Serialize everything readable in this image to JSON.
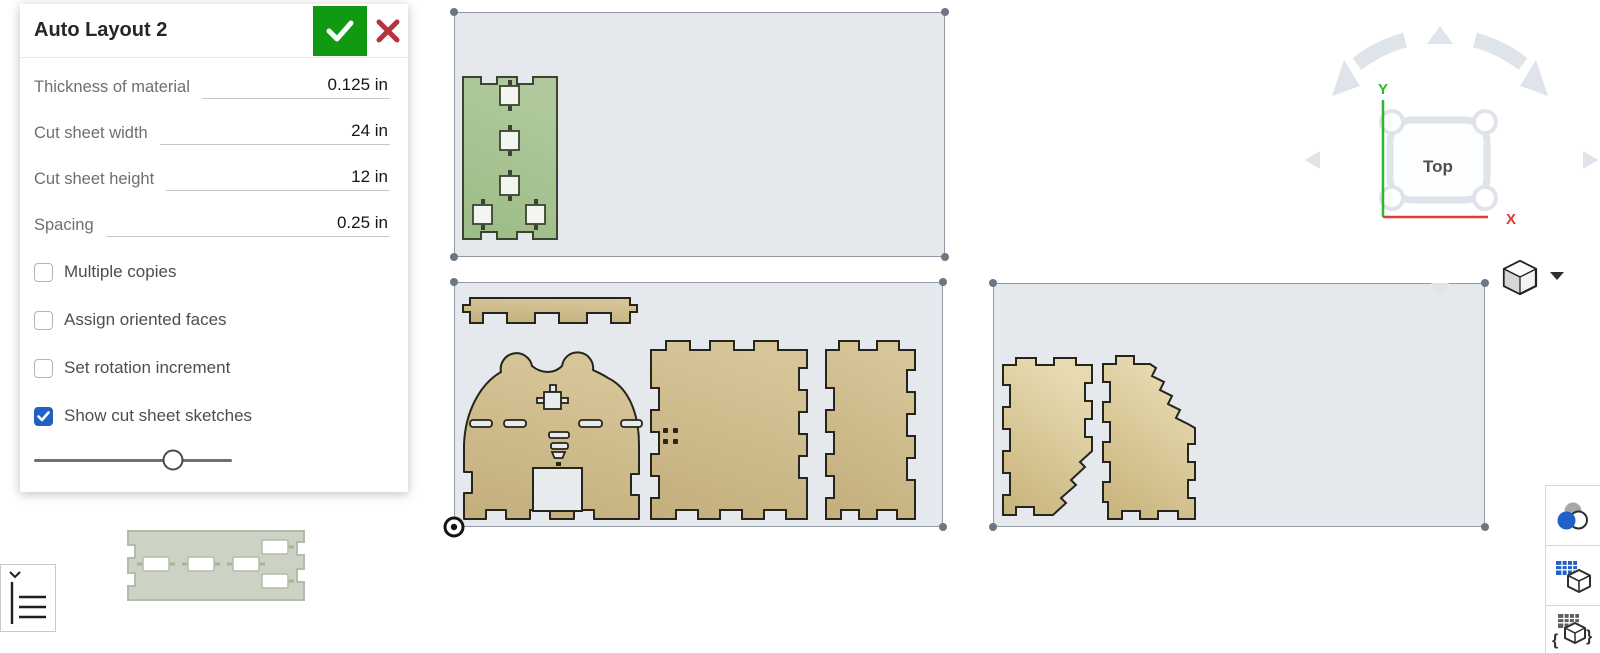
{
  "dialog": {
    "title": "Auto Layout 2",
    "confirm_icon": "check-icon",
    "cancel_icon": "x-icon",
    "fields": [
      {
        "label": "Thickness of material",
        "value": "0.125 in"
      },
      {
        "label": "Cut sheet width",
        "value": "24 in"
      },
      {
        "label": "Cut sheet height",
        "value": "12 in"
      },
      {
        "label": "Spacing",
        "value": "0.25 in"
      }
    ],
    "checkboxes": [
      {
        "label": "Multiple copies",
        "checked": false
      },
      {
        "label": "Assign oriented faces",
        "checked": false
      },
      {
        "label": "Set rotation increment",
        "checked": false
      },
      {
        "label": "Show cut sheet sketches",
        "checked": true
      }
    ],
    "slider_percent": 70
  },
  "view_navigator": {
    "face_label": "Top",
    "axis_x": "X",
    "axis_y": "Y"
  },
  "canvas": {
    "sheet_count": 3,
    "cut_parts": [
      "green-slotted-panel",
      "notched-strip",
      "animal-face-panel",
      "finger-joint-panel-large",
      "finger-joint-panel-narrow",
      "side-panel-left",
      "side-panel-right"
    ],
    "floating_part": "pale-slotted-strip"
  },
  "colors": {
    "accent_blue": "#2160c4",
    "confirm_green": "#119a11",
    "cancel_red": "#b5333d",
    "axis_x_red": "#e03a34",
    "axis_y_green": "#2fb52f",
    "sheet_fill": "#e5e8ec",
    "sheet_border": "#939aa4",
    "part_tan": "#c9b584",
    "part_green": "#a6c492",
    "part_pale": "#ccd3c5"
  }
}
